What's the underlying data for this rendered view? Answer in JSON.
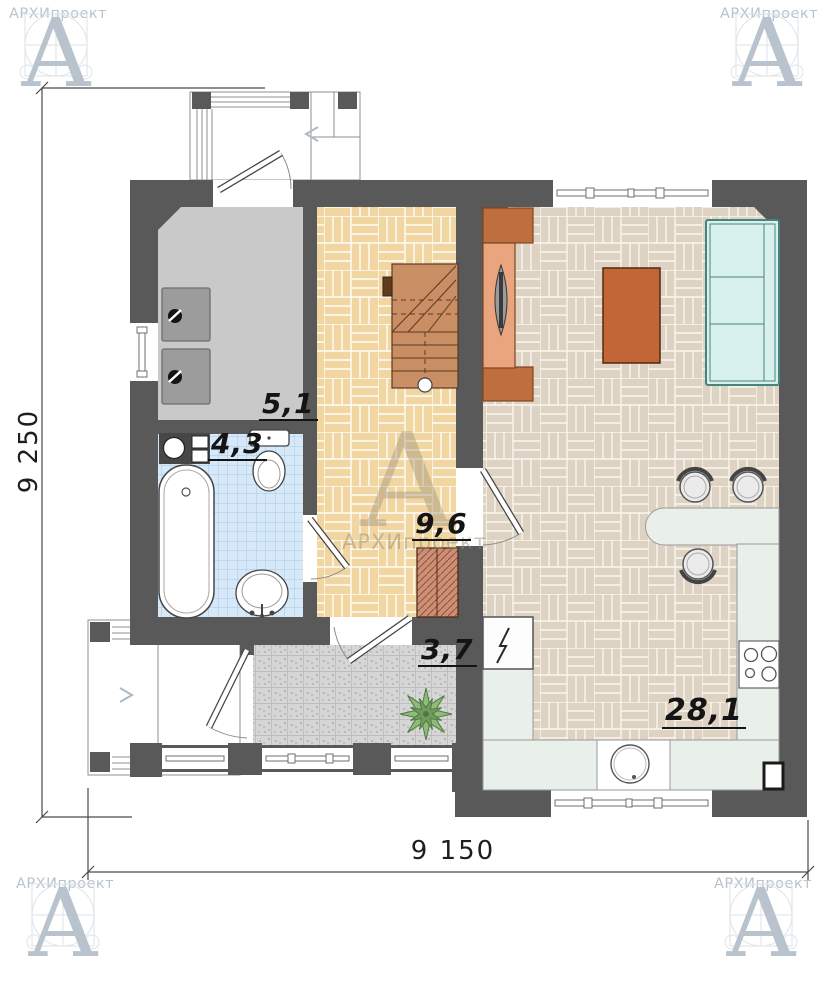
{
  "brand": {
    "letter": "А",
    "name": "АРХИпроект"
  },
  "plan": {
    "rooms": [
      {
        "name": "utility",
        "area": "5,1"
      },
      {
        "name": "bathroom",
        "area": "4,3"
      },
      {
        "name": "hallway-stairs",
        "area": "9,6"
      },
      {
        "name": "entry",
        "area": "3,7"
      },
      {
        "name": "living-kitchen",
        "area": "28,1"
      }
    ],
    "dimensions": {
      "horizontal": "9 150",
      "vertical": "9 250"
    }
  },
  "colors": {
    "wall": "#595959",
    "utility_floor": "#c9c9c9",
    "bath_tile": "#d7e9f8",
    "hall_floor": "#f1d6a2",
    "living_floor": "#ded2c2",
    "entry_tile": "#d6d6d6",
    "stairs": "#c98e63",
    "wood_furniture": "#bf6f3d",
    "sofa": "#d9f1ee",
    "kitchen_counter": "#e9efe9",
    "hatch_cabinet": "#cf8f74",
    "plant": "#8fbb7d",
    "logo": "#b9c3cd"
  }
}
